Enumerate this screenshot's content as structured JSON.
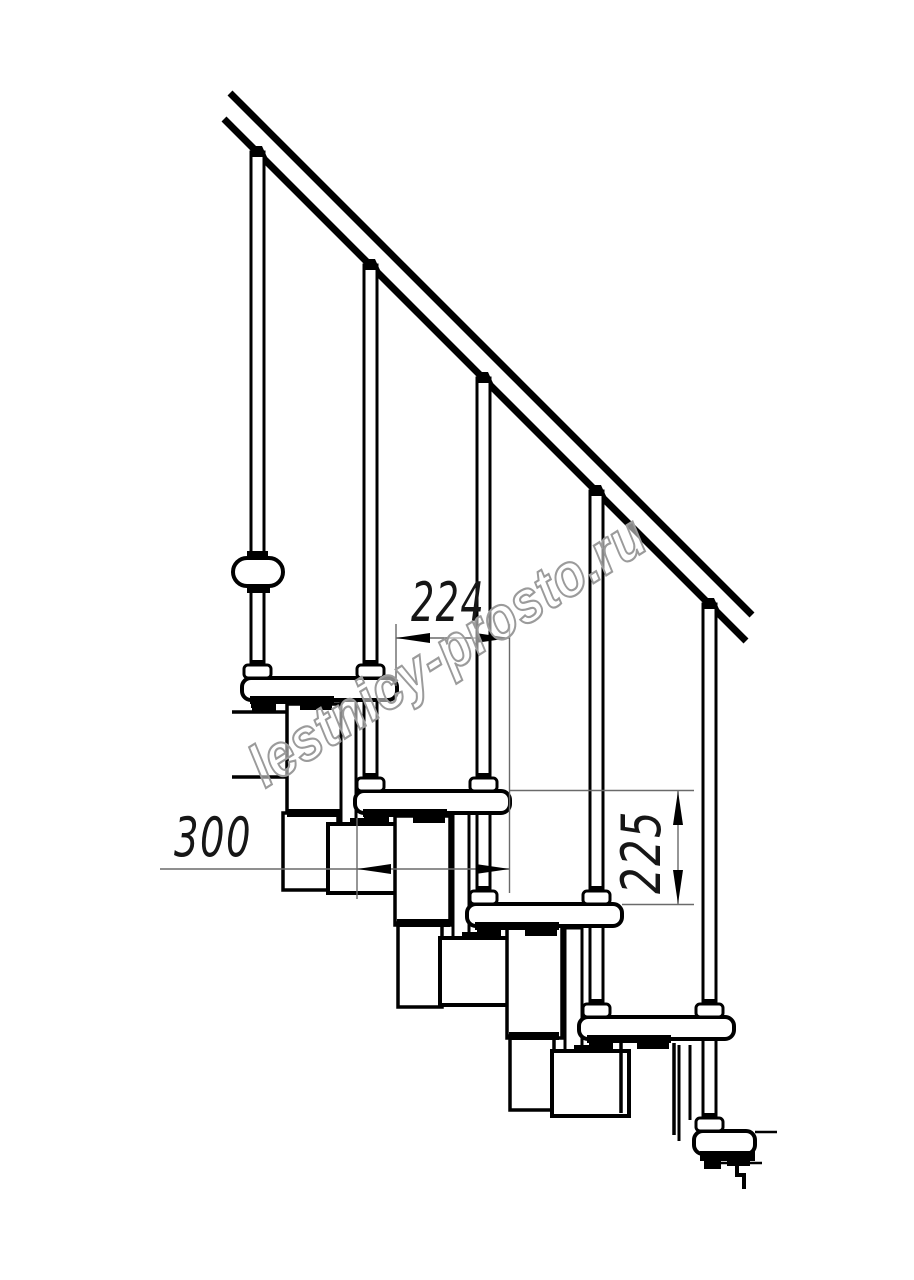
{
  "watermark": {
    "text": "lestnicy-prosto.ru"
  },
  "dimensions": {
    "step_run": {
      "label": "224"
    },
    "module_run": {
      "label": "300"
    },
    "step_rise": {
      "label": "225"
    }
  },
  "drawing": {
    "canvas": {
      "w": 914,
      "h": 1280
    },
    "colors": {
      "ink": "#000000",
      "thin_line": "#6a6a6a",
      "paper": "#ffffff"
    },
    "primitives": [
      {
        "n": "handrail-top-line",
        "t": "line",
        "x1": 230,
        "y1": 93,
        "x2": 752,
        "y2": 615,
        "sw": 7
      },
      {
        "n": "handrail-bottom-line",
        "t": "line",
        "x1": 224,
        "y1": 119,
        "x2": 746,
        "y2": 641,
        "sw": 7
      },
      {
        "n": "baluster-1",
        "t": "rect",
        "x": 251,
        "y": 152,
        "w": 13,
        "h": 530,
        "sw": 3
      },
      {
        "n": "baluster-2",
        "t": "rect",
        "x": 364,
        "y": 265,
        "w": 13,
        "h": 530,
        "sw": 3
      },
      {
        "n": "baluster-3",
        "t": "rect",
        "x": 477,
        "y": 378,
        "w": 13,
        "h": 530,
        "sw": 3
      },
      {
        "n": "baluster-4",
        "t": "rect",
        "x": 590,
        "y": 491,
        "w": 13,
        "h": 530,
        "sw": 3
      },
      {
        "n": "baluster-5",
        "t": "rect",
        "x": 703,
        "y": 604,
        "w": 13,
        "h": 530,
        "sw": 3
      },
      {
        "n": "baluster-1-rail-cap",
        "t": "poly",
        "pts": "250,157 267,157 262,146 254,146"
      },
      {
        "n": "baluster-2-rail-cap",
        "t": "poly",
        "pts": "363,270 380,270 375,259 367,259"
      },
      {
        "n": "baluster-3-rail-cap",
        "t": "poly",
        "pts": "476,383 493,383 488,372 480,372"
      },
      {
        "n": "baluster-4-rail-cap",
        "t": "poly",
        "pts": "589,496 606,496 601,485 593,485"
      },
      {
        "n": "baluster-5-rail-cap",
        "t": "poly",
        "pts": "702,609 719,609 714,598 706,598"
      },
      {
        "n": "landing-edge-upper-line",
        "t": "line",
        "x1": 232,
        "y1": 712,
        "x2": 288,
        "y2": 712,
        "sw": 3.5
      },
      {
        "n": "landing-edge-lower-line",
        "t": "line",
        "x1": 232,
        "y1": 777,
        "x2": 288,
        "y2": 777,
        "sw": 3.5
      },
      {
        "n": "support-module-a1",
        "t": "rect",
        "x": 287,
        "y": 704,
        "w": 55,
        "h": 109,
        "sw": 3.5
      },
      {
        "n": "riser-plate-1",
        "t": "rect",
        "x": 341,
        "y": 697,
        "w": 15,
        "h": 130,
        "sw": 3
      },
      {
        "n": "support-module-a1-lower",
        "t": "rect",
        "x": 283,
        "y": 813,
        "w": 55,
        "h": 77,
        "sw": 3.5
      },
      {
        "n": "module-joint-1",
        "t": "rect",
        "x": 287,
        "y": 809,
        "w": 54,
        "h": 8,
        "f": "ink"
      },
      {
        "n": "support-module-b1",
        "t": "rect",
        "x": 328,
        "y": 824,
        "w": 75,
        "h": 69,
        "sw": 4
      },
      {
        "n": "module-b1-tab",
        "t": "rect",
        "x": 350,
        "y": 818,
        "w": 20,
        "h": 7,
        "f": "ink"
      },
      {
        "n": "support-module-a2",
        "t": "rect",
        "x": 395,
        "y": 816,
        "w": 55,
        "h": 109,
        "sw": 3.5
      },
      {
        "n": "riser-plate-2",
        "t": "rect",
        "x": 453,
        "y": 810,
        "w": 16,
        "h": 130,
        "sw": 3
      },
      {
        "n": "support-module-a2-lower",
        "t": "rect",
        "x": 398,
        "y": 923,
        "w": 44,
        "h": 84,
        "sw": 3.5
      },
      {
        "n": "module-joint-2",
        "t": "rect",
        "x": 397,
        "y": 919,
        "w": 53,
        "h": 8,
        "f": "ink"
      },
      {
        "n": "support-module-b2",
        "t": "rect",
        "x": 440,
        "y": 938,
        "w": 77,
        "h": 67,
        "sw": 4
      },
      {
        "n": "module-b2-tab",
        "t": "rect",
        "x": 462,
        "y": 932,
        "w": 20,
        "h": 7,
        "f": "ink"
      },
      {
        "n": "support-module-a3",
        "t": "rect",
        "x": 507,
        "y": 926,
        "w": 55,
        "h": 112,
        "sw": 3.5
      },
      {
        "n": "riser-plate-3",
        "t": "rect",
        "x": 565,
        "y": 928,
        "w": 17,
        "h": 125,
        "sw": 3
      },
      {
        "n": "support-module-a3-lower",
        "t": "rect",
        "x": 510,
        "y": 1036,
        "w": 44,
        "h": 74,
        "sw": 3.5
      },
      {
        "n": "module-joint-3",
        "t": "rect",
        "x": 509,
        "y": 1032,
        "w": 50,
        "h": 8,
        "f": "ink"
      },
      {
        "n": "support-module-b3",
        "t": "rect",
        "x": 552,
        "y": 1051,
        "w": 77,
        "h": 65,
        "sw": 4
      },
      {
        "n": "module-b3-tab",
        "t": "rect",
        "x": 574,
        "y": 1045,
        "w": 20,
        "h": 7,
        "f": "ink"
      },
      {
        "n": "support-module-a4-left-line",
        "t": "line",
        "x1": 621,
        "y1": 1043,
        "x2": 621,
        "y2": 1113,
        "sw": 3.5
      },
      {
        "n": "support-module-a4-right-line",
        "t": "line",
        "x1": 674,
        "y1": 1043,
        "x2": 674,
        "y2": 1135,
        "sw": 3.5
      },
      {
        "n": "riser-plate-4-left-line",
        "t": "line",
        "x1": 679,
        "y1": 1045,
        "x2": 679,
        "y2": 1141,
        "sw": 3
      },
      {
        "n": "riser-plate-4-right-line",
        "t": "line",
        "x1": 690,
        "y1": 1045,
        "x2": 690,
        "y2": 1120,
        "sw": 3
      },
      {
        "n": "tread-1",
        "t": "rect",
        "x": 242,
        "y": 678,
        "w": 155,
        "h": 22,
        "rx": 9,
        "sw": 4
      },
      {
        "n": "tread-2",
        "t": "rect",
        "x": 355,
        "y": 791,
        "w": 155,
        "h": 22,
        "rx": 9,
        "sw": 4
      },
      {
        "n": "tread-3",
        "t": "rect",
        "x": 467,
        "y": 904,
        "w": 155,
        "h": 22,
        "rx": 9,
        "sw": 4
      },
      {
        "n": "tread-4",
        "t": "rect",
        "x": 579,
        "y": 1017,
        "w": 155,
        "h": 22,
        "rx": 9,
        "sw": 4
      },
      {
        "n": "tread-5",
        "t": "rect",
        "x": 694,
        "y": 1131,
        "w": 61,
        "h": 23,
        "rx": 9,
        "sw": 4
      },
      {
        "n": "tread-5-edge-line",
        "t": "line",
        "x1": 755,
        "y1": 1132,
        "x2": 777,
        "y2": 1132,
        "sw": 2.5
      },
      {
        "n": "under-tread-strip-1",
        "t": "rect",
        "x": 250,
        "y": 696,
        "w": 84,
        "h": 8,
        "f": "ink"
      },
      {
        "n": "tread-1-tab-a",
        "t": "rect",
        "x": 252,
        "y": 702,
        "w": 24,
        "h": 9,
        "f": "ink"
      },
      {
        "n": "tread-1-tab-b",
        "t": "rect",
        "x": 300,
        "y": 702,
        "w": 32,
        "h": 8,
        "f": "ink"
      },
      {
        "n": "under-tread-strip-2",
        "t": "rect",
        "x": 363,
        "y": 809,
        "w": 84,
        "h": 8,
        "f": "ink"
      },
      {
        "n": "tread-2-tab-a",
        "t": "rect",
        "x": 365,
        "y": 815,
        "w": 24,
        "h": 9,
        "f": "ink"
      },
      {
        "n": "tread-2-tab-b",
        "t": "rect",
        "x": 413,
        "y": 815,
        "w": 32,
        "h": 8,
        "f": "ink"
      },
      {
        "n": "under-tread-strip-3",
        "t": "rect",
        "x": 475,
        "y": 922,
        "w": 84,
        "h": 8,
        "f": "ink"
      },
      {
        "n": "tread-3-tab-a",
        "t": "rect",
        "x": 477,
        "y": 928,
        "w": 24,
        "h": 9,
        "f": "ink"
      },
      {
        "n": "tread-3-tab-b",
        "t": "rect",
        "x": 525,
        "y": 928,
        "w": 32,
        "h": 8,
        "f": "ink"
      },
      {
        "n": "under-tread-strip-4",
        "t": "rect",
        "x": 587,
        "y": 1035,
        "w": 84,
        "h": 8,
        "f": "ink"
      },
      {
        "n": "tread-4-tab-a",
        "t": "rect",
        "x": 589,
        "y": 1041,
        "w": 24,
        "h": 9,
        "f": "ink"
      },
      {
        "n": "tread-4-tab-b",
        "t": "rect",
        "x": 637,
        "y": 1041,
        "w": 32,
        "h": 8,
        "f": "ink"
      },
      {
        "n": "under-tread-strip-5",
        "t": "rect",
        "x": 700,
        "y": 1151,
        "w": 55,
        "h": 10,
        "f": "ink"
      },
      {
        "n": "tread-5-tab-a",
        "t": "rect",
        "x": 704,
        "y": 1160,
        "w": 17,
        "h": 9,
        "f": "ink"
      },
      {
        "n": "tread-5-tab-b",
        "t": "rect",
        "x": 727,
        "y": 1156,
        "w": 23,
        "h": 10,
        "f": "ink"
      },
      {
        "n": "baluster-1-foot",
        "t": "rect",
        "x": 251,
        "y": 700,
        "w": 13,
        "h": 8,
        "f": "ink"
      },
      {
        "n": "baluster-2-foot",
        "t": "rect",
        "x": 364,
        "y": 813,
        "w": 13,
        "h": 8,
        "f": "ink"
      },
      {
        "n": "baluster-3-foot",
        "t": "rect",
        "x": 477,
        "y": 926,
        "w": 14,
        "h": 8,
        "f": "ink"
      },
      {
        "n": "baluster-4-foot",
        "t": "rect",
        "x": 590,
        "y": 1039,
        "w": 13,
        "h": 8,
        "f": "ink"
      },
      {
        "n": "baluster-5-foot",
        "t": "rect",
        "x": 703,
        "y": 1152,
        "w": 13,
        "h": 8,
        "f": "ink"
      },
      {
        "n": "wall-bracket",
        "t": "rect",
        "x": 233,
        "y": 558,
        "w": 50,
        "h": 28,
        "rx": 14,
        "sw": 4
      },
      {
        "n": "wall-bracket-cap-top",
        "t": "rect",
        "x": 247,
        "y": 551,
        "w": 21,
        "h": 8,
        "f": "ink"
      },
      {
        "n": "wall-bracket-cap-bottom",
        "t": "rect",
        "x": 247,
        "y": 585,
        "w": 23,
        "h": 8,
        "f": "ink"
      },
      {
        "n": "baluster-collar-1",
        "t": "rect",
        "x": 244,
        "y": 665,
        "w": 27,
        "h": 13,
        "rx": 4,
        "sw": 3
      },
      {
        "n": "collar-cap-1",
        "t": "rect",
        "x": 250,
        "y": 660,
        "w": 15,
        "h": 6,
        "f": "ink"
      },
      {
        "n": "baluster-collar-2",
        "t": "rect",
        "x": 357,
        "y": 665,
        "w": 27,
        "h": 13,
        "rx": 4,
        "sw": 3
      },
      {
        "n": "collar-cap-2",
        "t": "rect",
        "x": 363,
        "y": 660,
        "w": 15,
        "h": 6,
        "f": "ink"
      },
      {
        "n": "baluster-collar-3",
        "t": "rect",
        "x": 357,
        "y": 778,
        "w": 27,
        "h": 13,
        "rx": 4,
        "sw": 3
      },
      {
        "n": "collar-cap-3",
        "t": "rect",
        "x": 363,
        "y": 773,
        "w": 15,
        "h": 6,
        "f": "ink"
      },
      {
        "n": "baluster-collar-4",
        "t": "rect",
        "x": 470,
        "y": 778,
        "w": 27,
        "h": 13,
        "rx": 4,
        "sw": 3
      },
      {
        "n": "collar-cap-4",
        "t": "rect",
        "x": 476,
        "y": 773,
        "w": 15,
        "h": 6,
        "f": "ink"
      },
      {
        "n": "baluster-collar-5",
        "t": "rect",
        "x": 470,
        "y": 891,
        "w": 27,
        "h": 13,
        "rx": 4,
        "sw": 3
      },
      {
        "n": "collar-cap-5",
        "t": "rect",
        "x": 476,
        "y": 886,
        "w": 15,
        "h": 6,
        "f": "ink"
      },
      {
        "n": "baluster-collar-6",
        "t": "rect",
        "x": 583,
        "y": 891,
        "w": 27,
        "h": 13,
        "rx": 4,
        "sw": 3
      },
      {
        "n": "collar-cap-6",
        "t": "rect",
        "x": 589,
        "y": 886,
        "w": 15,
        "h": 6,
        "f": "ink"
      },
      {
        "n": "baluster-collar-7",
        "t": "rect",
        "x": 583,
        "y": 1004,
        "w": 27,
        "h": 13,
        "rx": 4,
        "sw": 3
      },
      {
        "n": "collar-cap-7",
        "t": "rect",
        "x": 589,
        "y": 999,
        "w": 15,
        "h": 6,
        "f": "ink"
      },
      {
        "n": "baluster-collar-8",
        "t": "rect",
        "x": 696,
        "y": 1004,
        "w": 27,
        "h": 13,
        "rx": 4,
        "sw": 3
      },
      {
        "n": "collar-cap-8",
        "t": "rect",
        "x": 702,
        "y": 999,
        "w": 15,
        "h": 6,
        "f": "ink"
      },
      {
        "n": "baluster-collar-9",
        "t": "rect",
        "x": 696,
        "y": 1118,
        "w": 27,
        "h": 13,
        "rx": 4,
        "sw": 3
      },
      {
        "n": "collar-cap-9",
        "t": "rect",
        "x": 702,
        "y": 1113,
        "w": 15,
        "h": 6,
        "f": "ink"
      },
      {
        "n": "bottom-step-edge-line",
        "t": "line",
        "x1": 713,
        "y1": 1163,
        "x2": 762,
        "y2": 1163,
        "sw": 2.5
      },
      {
        "n": "bottom-step-outline",
        "t": "path",
        "d": "M737,1163 L737,1175 L744,1175 L744,1189",
        "sw": 4
      },
      {
        "n": "dim-224-ext-left",
        "t": "line",
        "x1": 396,
        "y1": 624,
        "x2": 396,
        "y2": 686,
        "sw": 1.4,
        "c": "thin"
      },
      {
        "n": "dim-224-ext-right",
        "t": "line",
        "x1": 509.5,
        "y1": 624,
        "x2": 509.5,
        "y2": 893,
        "sw": 1.4,
        "c": "thin"
      },
      {
        "n": "dim-224-line",
        "t": "line",
        "x1": 396,
        "y1": 638,
        "x2": 509.5,
        "y2": 638,
        "sw": 1.4,
        "c": "thin"
      },
      {
        "n": "dim-224-arrow-left",
        "t": "poly",
        "pts": "396,638 430,633 430,643"
      },
      {
        "n": "dim-224-arrow-right",
        "t": "poly",
        "pts": "509.5,638 475.5,633 475.5,643"
      },
      {
        "n": "dim-224-label",
        "t": "text",
        "ref": "dimensions.step_run.label",
        "x": 448,
        "y": 621,
        "fs": 54,
        "tl": 74,
        "style": "dim"
      },
      {
        "n": "dim-300-ext",
        "t": "line",
        "x1": 357,
        "y1": 818,
        "x2": 357,
        "y2": 899,
        "sw": 1.4,
        "c": "thin"
      },
      {
        "n": "dim-300-line",
        "t": "line",
        "x1": 160,
        "y1": 869,
        "x2": 509.5,
        "y2": 869,
        "sw": 1.4,
        "c": "thin"
      },
      {
        "n": "dim-300-arrow-left",
        "t": "poly",
        "pts": "357,869 391,864 391,874"
      },
      {
        "n": "dim-300-arrow-right",
        "t": "poly",
        "pts": "509.5,869 475.5,864 475.5,874"
      },
      {
        "n": "dim-300-label",
        "t": "text",
        "ref": "dimensions.module_run.label",
        "x": 213,
        "y": 856,
        "fs": 54,
        "tl": 78,
        "style": "dim"
      },
      {
        "n": "dim-225-ref-top",
        "t": "line",
        "x1": 510,
        "y1": 790.5,
        "x2": 694,
        "y2": 790.5,
        "sw": 1.4,
        "c": "thin"
      },
      {
        "n": "dim-225-ref-bottom",
        "t": "line",
        "x1": 622,
        "y1": 904.5,
        "x2": 694,
        "y2": 904.5,
        "sw": 1.4,
        "c": "thin"
      },
      {
        "n": "dim-225-line",
        "t": "line",
        "x1": 678,
        "y1": 791,
        "x2": 678,
        "y2": 904,
        "sw": 1.4,
        "c": "thin"
      },
      {
        "n": "dim-225-arrow-up",
        "t": "poly",
        "pts": "678,791 673,825 683,825"
      },
      {
        "n": "dim-225-arrow-down",
        "t": "poly",
        "pts": "678,904 673,870 683,870"
      },
      {
        "n": "dim-225-label",
        "t": "text",
        "ref": "dimensions.step_rise.label",
        "x": 660,
        "y": 852,
        "rot": -90,
        "fs": 54,
        "tl": 84,
        "style": "dim"
      },
      {
        "n": "watermark-text",
        "t": "text",
        "ref": "watermark.text",
        "x": 458,
        "y": 668,
        "rot": -32,
        "fs": 60,
        "tl": 455,
        "style": "wm"
      }
    ]
  }
}
